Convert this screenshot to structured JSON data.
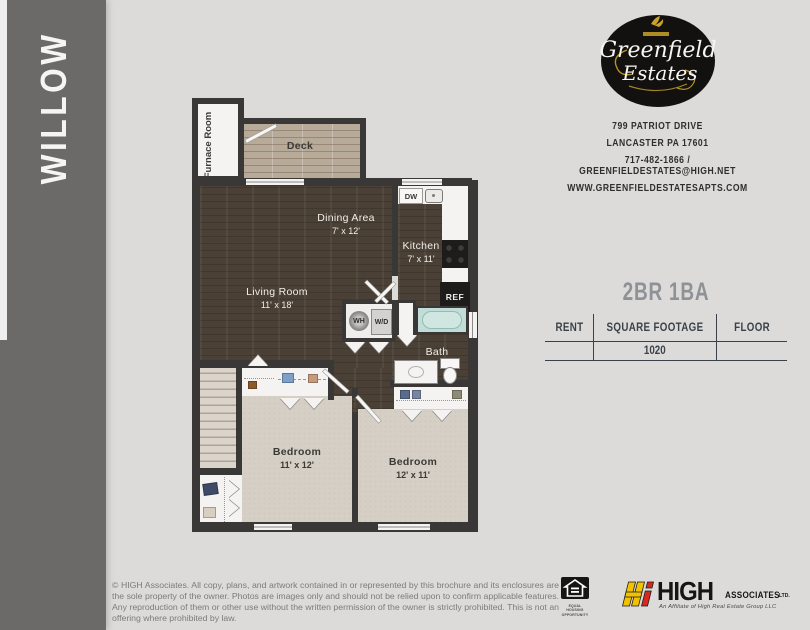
{
  "sidebar": {
    "title": "WILLOW"
  },
  "brand": {
    "logo_line1": "Greenfield",
    "logo_line2": "Estates",
    "address_line1": "799 PATRIOT DRIVE",
    "address_line2": "LANCASTER PA 17601",
    "address_line3": "717-482-1866 / GREENFIELDESTATES@HIGH.NET",
    "address_line4": "WWW.GREENFIELDESTATESAPTS.COM"
  },
  "unit": {
    "title": "2BR 1BA",
    "table": {
      "headers": [
        "RENT",
        "SQUARE FOOTAGE",
        "FLOOR"
      ],
      "rent_value": "",
      "square_footage_value": "1020",
      "floor_value": ""
    }
  },
  "floorplan": {
    "rooms": {
      "furnace": {
        "name": "Furnace Room"
      },
      "deck": {
        "name": "Deck"
      },
      "dining": {
        "name": "Dining Area",
        "dims": "7' x 12'"
      },
      "kitchen": {
        "name": "Kitchen",
        "dims": "7' x 11'"
      },
      "living": {
        "name": "Living Room",
        "dims": "11' x 18'"
      },
      "bath": {
        "name": "Bath"
      },
      "bedroom1": {
        "name": "Bedroom",
        "dims": "11' x 12'"
      },
      "bedroom2": {
        "name": "Bedroom",
        "dims": "12' x 11'"
      }
    },
    "appliances": {
      "dishwasher": "DW",
      "refrigerator": "REF",
      "water_heater": "WH",
      "washer_dryer": "W/D"
    }
  },
  "footer": {
    "copyright": "© HIGH Associates. All copy, plans, and artwork contained in or represented by this brochure and its enclosures are the sole property of the owner. Photos are images only and should not be relied upon to confirm applicable features. Any reproduction of them or other use without the written permission of the owner is strictly prohibited. This is not an offering where prohibited by law.",
    "equal_housing_label": "EQUAL HOUSING OPPORTUNITY",
    "high_logo": {
      "brand": "HIGH",
      "suffix": "ASSOCIATES",
      "ltd": "LTD.",
      "tagline": "An Affiliate of High Real Estate Group LLC"
    }
  },
  "colors": {
    "sidebar": "#6b6a68",
    "wall": "#3a3836",
    "dark_wood": "#4a4036",
    "deck_wood": "#b7aa98",
    "carpet": "#d6cfc5",
    "tub": "#c2ddd8",
    "accent_gold": "#c9a227",
    "high_yellow": "#f2c200",
    "high_red": "#d8291f",
    "table_ink": "#39424b",
    "title_gray": "#8e9196"
  }
}
